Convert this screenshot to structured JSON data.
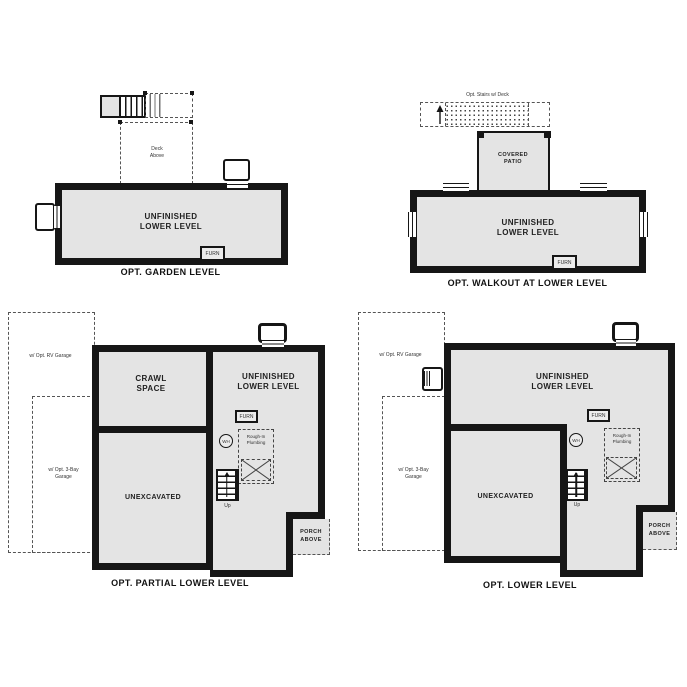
{
  "colors": {
    "wall": "#161616",
    "room_fill": "#e4e4e4",
    "background": "#ffffff"
  },
  "garden": {
    "caption": "OPT. GARDEN LEVEL",
    "room": "UNFINISHED\nLOWER LEVEL",
    "deck": "Deck\nAbove",
    "furnace": "FURN"
  },
  "walkout": {
    "caption": "OPT. WALKOUT AT LOWER LEVEL",
    "room": "UNFINISHED\nLOWER LEVEL",
    "patio": "COVERED\nPATIO",
    "deck": "Opt. Stairs w/ Deck",
    "furnace": "FURN"
  },
  "partial": {
    "caption": "OPT. PARTIAL LOWER LEVEL",
    "room": "UNFINISHED\nLOWER LEVEL",
    "crawl": "CRAWL\nSPACE",
    "unexcavated": "UNEXCAVATED",
    "furnace": "FURN",
    "water_heater": "WH",
    "plumbing": "Rough-In\nPlumbing",
    "up": "Up",
    "porch": "PORCH\nABOVE",
    "rv_garage": "w/ Opt. RV Garage",
    "bay_garage": "w/ Opt. 3-Bay\nGarage"
  },
  "lower": {
    "caption": "OPT. LOWER LEVEL",
    "room": "UNFINISHED\nLOWER LEVEL",
    "unexcavated": "UNEXCAVATED",
    "furnace": "FURN",
    "water_heater": "WH",
    "plumbing": "Rough-In\nPlumbing",
    "up": "Up",
    "porch": "PORCH\nABOVE",
    "rv_garage": "w/ Opt. RV Garage",
    "bay_garage": "w/ Opt. 3-Bay\nGarage"
  }
}
